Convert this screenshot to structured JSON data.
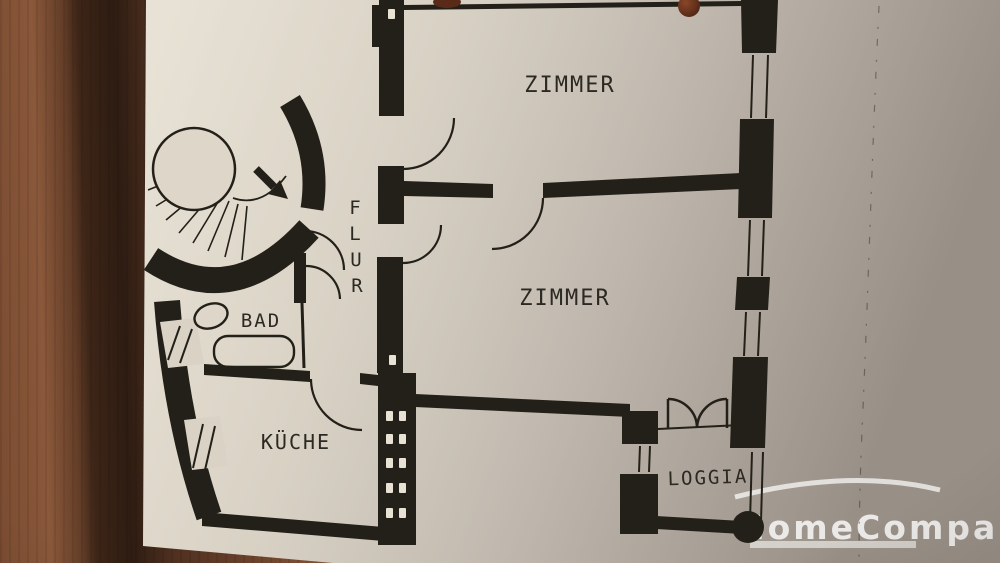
{
  "document": {
    "kind": "apartment floor plan photo on wooden table",
    "labels": {
      "zimmer_top": "ZIMMER",
      "zimmer_middle": "ZIMMER",
      "flur": "FLUR",
      "flur_letters": [
        "F",
        "L",
        "U",
        "R"
      ],
      "bad": "BAD",
      "kueche": "KÜCHE",
      "loggia": "LOGGIA"
    },
    "watermark": {
      "text": "HomeCompany"
    },
    "colors": {
      "ink": "#232019",
      "paper_light": "#e6dfd2",
      "paper_dark": "#b3aba2",
      "wood_light": "#8a583a",
      "wood_dark": "#2e1c12",
      "watermark_white": "#ffffff",
      "knob_brown": "#5a2d1b"
    }
  }
}
